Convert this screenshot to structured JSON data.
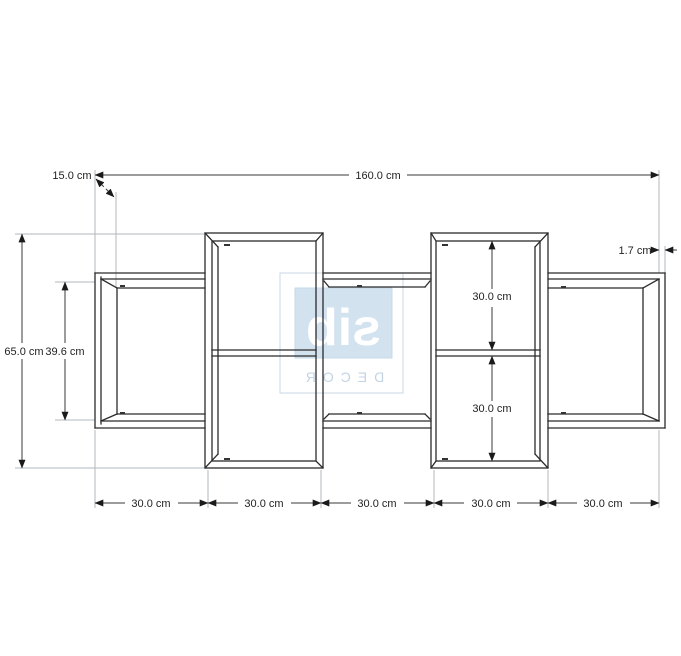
{
  "page": {
    "background": "#ffffff",
    "line_color": "#2b2b2b",
    "dim_color": "#3a3a3a",
    "ext_color": "#b3b9bf",
    "label_color": "#1f1f1f"
  },
  "watermark": {
    "brand": "sib",
    "brand_sub": "DECOR",
    "mirrored": true,
    "square_fill": "#d3e2ef",
    "square_border": "#c6d8ea",
    "frame_border": "#c9d7e5",
    "brand_color": "#ffffff",
    "sub_color": "#c2d3e4"
  },
  "dimensions": {
    "total_width": "160.0 cm",
    "depth": "15.0 cm",
    "total_height": "65.0 cm",
    "side_inner_height": "39.6 cm",
    "panel_thickness": "1.7 cm",
    "upper_compartment_height": "30.0 cm",
    "lower_compartment_height": "30.0 cm",
    "bottom_section_widths": [
      "30.0 cm",
      "30.0 cm",
      "30.0 cm",
      "30.0 cm",
      "30.0 cm"
    ]
  }
}
